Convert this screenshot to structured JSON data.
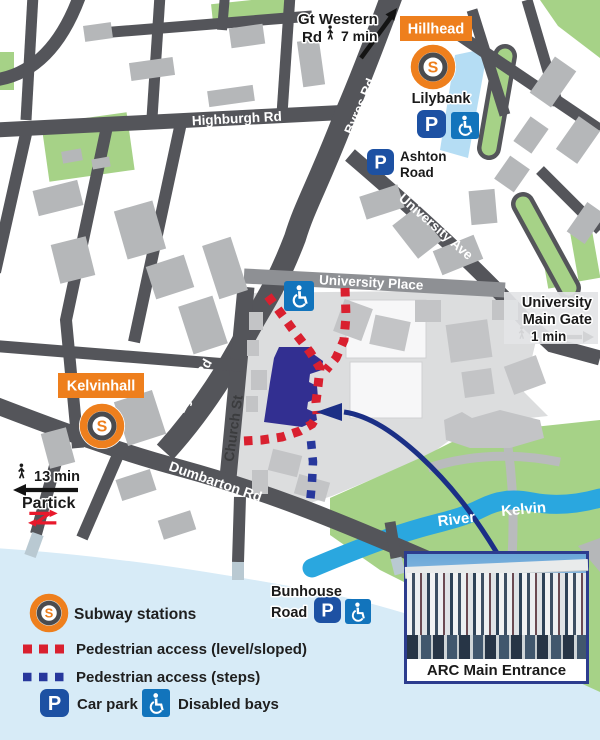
{
  "badges": {
    "hillhead": "Hillhead",
    "kelvinhall": "Kelvinhall"
  },
  "icons": {
    "s": "S",
    "p": "P"
  },
  "roads": {
    "highburgh": "Highburgh Rd",
    "byres": "Byres Rd",
    "university_ave": "University Ave",
    "university_place": "University Place",
    "church": "Church St",
    "dumbarton": "Dumbarton Rd"
  },
  "places": {
    "lilybank": "Lilybank",
    "ashton_1": "Ashton",
    "ashton_2": "Road",
    "bunhouse_1": "Bunhouse",
    "bunhouse_2": "Road",
    "river_1": "River",
    "river_2": "Kelvin"
  },
  "directions": {
    "gt_western_1": "Gt Western",
    "gt_western_2": "Rd",
    "gt_western_time": "7 min",
    "main_gate_1": "University",
    "main_gate_2": "Main Gate",
    "main_gate_time": "1 min",
    "partick_time": "13 min",
    "partick": "Partick"
  },
  "photo": {
    "caption": "ARC Main Entrance"
  },
  "legend": {
    "subway": "Subway stations",
    "level": "Pedestrian access (level/sloped)",
    "steps": "Pedestrian access (steps)",
    "car_park": "Car park",
    "disabled": "Disabled bays"
  },
  "colors": {
    "orange": "#ee7f1d",
    "road": "#54555a",
    "green": "#a6d287",
    "river": "#2aa7df",
    "arc_building": "#322f91",
    "red_path": "#d9202f",
    "steps_path": "#27379c",
    "car_park_blue": "#1d51a3",
    "disabled_blue": "#1274bc",
    "wash": "#d7ebf7"
  }
}
